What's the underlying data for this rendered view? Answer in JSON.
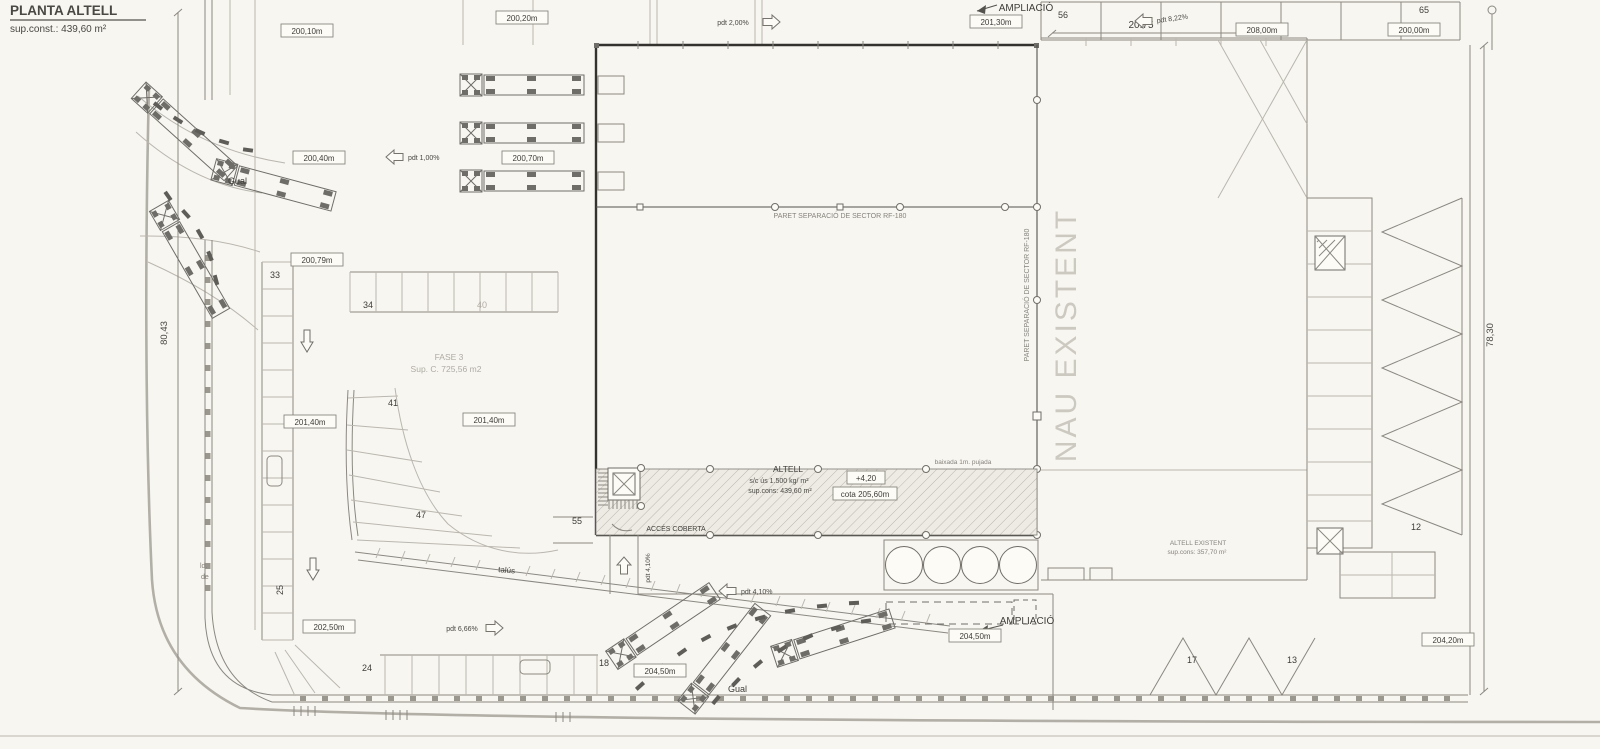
{
  "colors": {
    "paper": "#f8f6f1",
    "ink": "#3f3d38",
    "line": "#8a8880",
    "faint": "#bab7af",
    "title_red": "#9f4536",
    "muted": "#aeaba3"
  },
  "title": {
    "heading": "PLANTA ALTELL",
    "subheading": "sup.const.: 439,60 m²"
  },
  "dimensions": {
    "top": "20.75",
    "left": "80,43",
    "right": "78,30"
  },
  "callouts": {
    "ampliacio_top": "AMPLIACIÓ",
    "ampliacio_bottom": "AMPLIACIÓ",
    "sector_wall_h": "PARET SEPARACIÓ DE SECTOR RF-180",
    "sector_wall_v": "PARET SEPARACIÓ DE SECTOR RF-180",
    "nau_existent": "NAU EXISTENT",
    "acces_coberta": "ACCÉS COBERTA",
    "talus": "talús",
    "gual_top": "Gual",
    "gual_bottom": "Gual",
    "fase": "FASE 3",
    "fase_sup": "Sup. C. 725,56 m2",
    "street_1": "ld.",
    "street_2": "de",
    "ramp_note": "baixada 1m. pujada"
  },
  "altell": {
    "name": "ALTELL",
    "load": "s/c ús 1.500 kg/ m²",
    "area": "sup.cons: 439,60 m²",
    "level": "+4,20",
    "cota": "cota 205,60m"
  },
  "altell_existent": {
    "name": "ALTELL EXISTENT",
    "area": "sup.cons: 357,70 m²"
  },
  "levels": [
    {
      "text": "200,10m"
    },
    {
      "text": "200,20m"
    },
    {
      "text": "200,40m"
    },
    {
      "text": "200,70m"
    },
    {
      "text": "200,79m"
    },
    {
      "text": "201,40m"
    },
    {
      "text": "201,40m"
    },
    {
      "text": "202,50m"
    },
    {
      "text": "204,50m"
    },
    {
      "text": "204,50m"
    },
    {
      "text": "201,30m"
    },
    {
      "text": "208,00m"
    },
    {
      "text": "200,00m"
    },
    {
      "text": "204,20m"
    }
  ],
  "slopes": [
    {
      "text": "pdt 2,00%"
    },
    {
      "text": "pdt 1,00%"
    },
    {
      "text": "pdt 8,22%"
    },
    {
      "text": "pdt 4,10%"
    },
    {
      "text": "pdt 4,10%"
    },
    {
      "text": "pdt 6,66%"
    }
  ],
  "stalls": [
    "33",
    "34",
    "40",
    "41",
    "47",
    "55",
    "56",
    "65",
    "25",
    "24",
    "18",
    "12",
    "17",
    "13"
  ]
}
